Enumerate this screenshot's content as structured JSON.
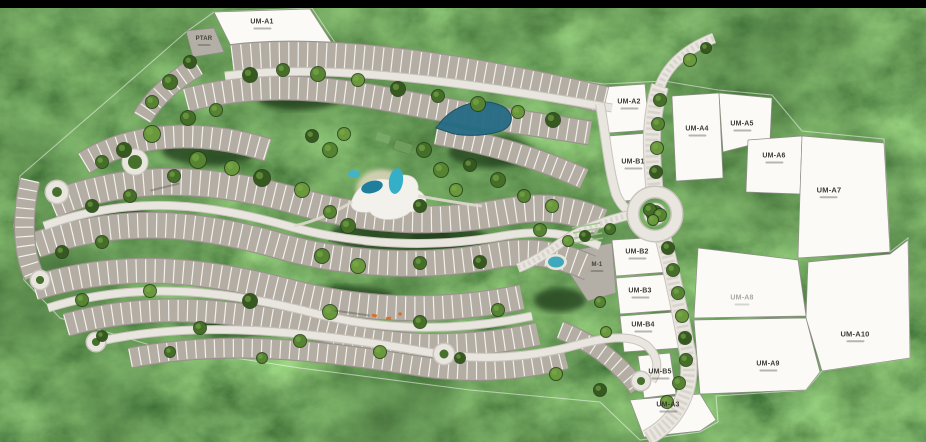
{
  "map": {
    "type": "residential-masterplan-aerial",
    "parcels": [
      {
        "id": "um-a1",
        "label": "UM-A1"
      },
      {
        "id": "ptar",
        "label": "PTAR"
      },
      {
        "id": "um-a2",
        "label": "UM-A2"
      },
      {
        "id": "um-b1",
        "label": "UM-B1"
      },
      {
        "id": "um-a4",
        "label": "UM-A4"
      },
      {
        "id": "um-a5",
        "label": "UM-A5"
      },
      {
        "id": "um-a6",
        "label": "UM-A6"
      },
      {
        "id": "um-a7",
        "label": "UM-A7"
      },
      {
        "id": "um-b2",
        "label": "UM-B2"
      },
      {
        "id": "m-1",
        "label": "M-1"
      },
      {
        "id": "um-b3",
        "label": "UM-B3"
      },
      {
        "id": "um-b4",
        "label": "UM-B4"
      },
      {
        "id": "um-a8",
        "label": "UM-A8"
      },
      {
        "id": "um-a10",
        "label": "UM-A10"
      },
      {
        "id": "um-a9",
        "label": "UM-A9"
      },
      {
        "id": "um-b5",
        "label": "UM-B5"
      },
      {
        "id": "um-a3",
        "label": "UM-A3"
      }
    ],
    "colors": {
      "forest_dark": "#1d2f12",
      "forest_mid": "#3f6526",
      "parcel_white": "#fbfaf7",
      "parcel_gray": "#b4afa6",
      "lot_gray": "#b3ada3",
      "road_light": "#e9e6e0",
      "pool_cyan": "#35aec8",
      "lagoon_teal": "#1e7e9b",
      "top_bar": "#000000"
    }
  }
}
